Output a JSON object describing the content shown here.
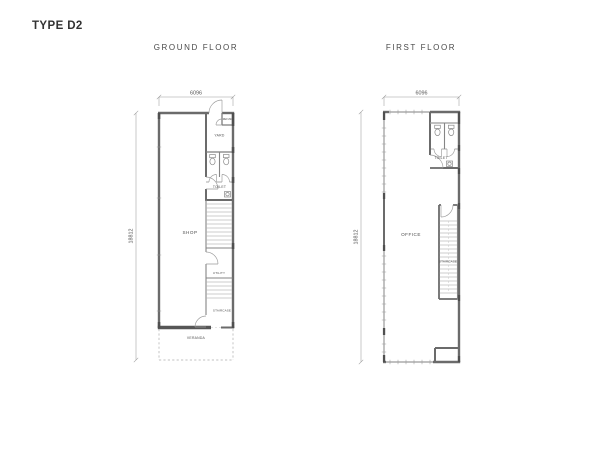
{
  "title": "TYPE D2",
  "colors": {
    "background": "#ffffff",
    "wall": "#6b6b6b",
    "heavy_wall": "#565656",
    "thin_line": "#9a9a9a",
    "text": "#4c4c4c",
    "title_text": "#333333"
  },
  "ground_floor": {
    "heading": "GROUND FLOOR",
    "dim_width": "6096",
    "dim_height": "18812",
    "labels": {
      "shop": "SHOP",
      "yard": "YARD",
      "refuse": "REFUSE",
      "toilet": "TOILET",
      "utility": "UTILITY",
      "staircase": "STAIRCASE",
      "veranda": "VERANDA"
    }
  },
  "first_floor": {
    "heading": "FIRST FLOOR",
    "dim_width": "6096",
    "dim_height": "18812",
    "labels": {
      "office": "OFFICE",
      "toilet": "TOILET",
      "staircase": "STAIRCASE"
    }
  }
}
